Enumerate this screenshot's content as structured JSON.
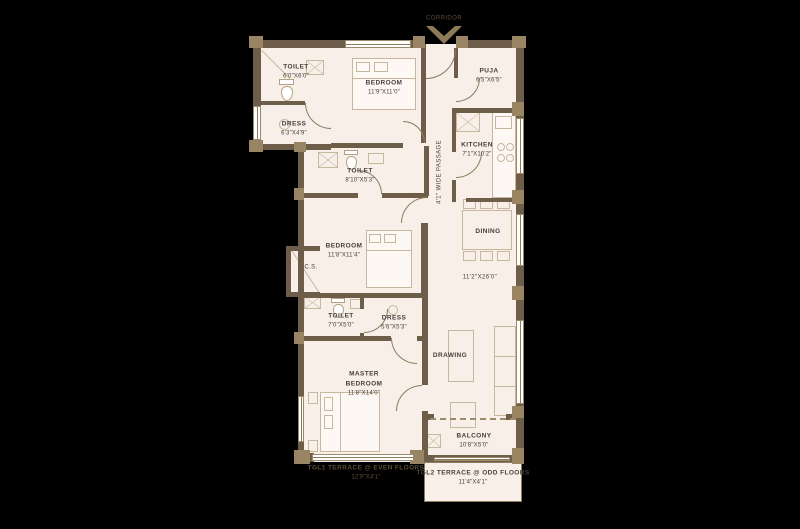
{
  "title": "Apartment Floor Plan",
  "colors": {
    "background": "#000000",
    "floor": "#f7efe8",
    "wall": "#6e5d49",
    "pilaster": "#998563",
    "line": "#8d7b5e",
    "label_text": "#46403a",
    "dim_label_text": "#5c4c38"
  },
  "rooms": {
    "toilet1": {
      "name": "TOILET",
      "dim": "6'0\"X6'0\""
    },
    "dress1": {
      "name": "DRESS",
      "dim": "6'3\"X4'9\""
    },
    "bedroom1": {
      "name": "BEDROOM",
      "dim": "11'9\"X11'0\""
    },
    "puja": {
      "name": "PUJA",
      "dim": "6'5\"X6'5\""
    },
    "kitchen": {
      "name": "KITCHEN",
      "dim": "7'1\"X10'2\""
    },
    "toilet2": {
      "name": "TOILET",
      "dim": "8'10\"X5'3\""
    },
    "bedroom2": {
      "name": "BEDROOM",
      "dim": "11'8\"X11'4\""
    },
    "toilet3": {
      "name": "TOILET",
      "dim": "7'0\"X5'0\""
    },
    "dress2": {
      "name": "DRESS",
      "dim": "5'6\"X5'3\""
    },
    "dining": {
      "name": "DINING"
    },
    "drawing": {
      "name": "DRAWING"
    },
    "master_bedroom": {
      "name": "MASTER BEDROOM",
      "dim": "11'8\"X14'0\""
    },
    "balcony": {
      "name": "BALCONY",
      "dim": "10'8\"X5'0\""
    }
  },
  "labels": {
    "corridor": "CORRIDOR",
    "passage": "4'1\" WIDE PASSAGE",
    "hall_dim": "11'2\"X26'0\"",
    "cupboard": "C.S.",
    "tgl1_line1": "TGL1 TERRACE @ EVEN FLOORS",
    "tgl1_line2": "12'9\"X4'1\"",
    "tgl2_line1": "TGL2 TERRACE @ ODD FLOORS",
    "tgl2_line2": "11'4\"X4'1\""
  }
}
